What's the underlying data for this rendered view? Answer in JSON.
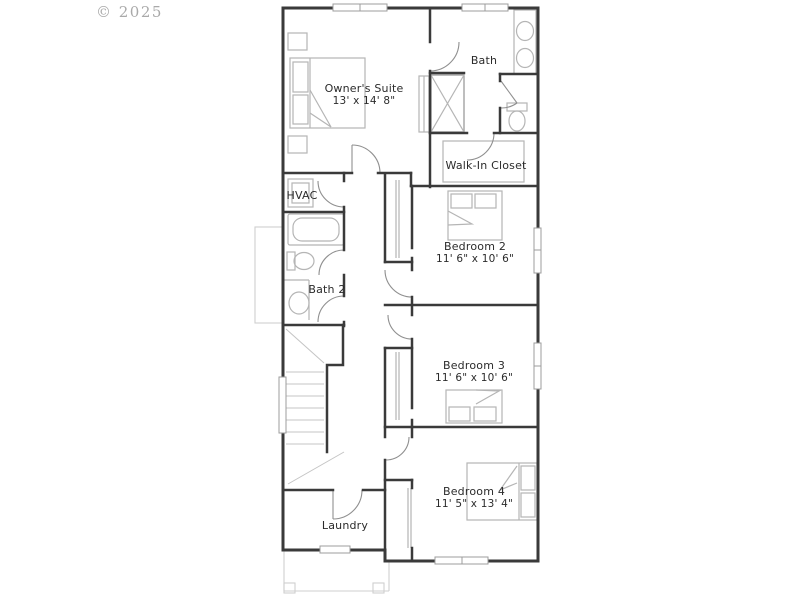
{
  "watermark": "© 2025",
  "rooms": {
    "owners_suite": {
      "name": "Owner's Suite",
      "dims": "13' x 14' 8\""
    },
    "bath": {
      "name": "Bath"
    },
    "walk_in_closet": {
      "name": "Walk-In Closet"
    },
    "hvac": {
      "name": "HVAC"
    },
    "bath_2": {
      "name": "Bath 2"
    },
    "bedroom_2": {
      "name": "Bedroom 2",
      "dims": "11' 6\" x 10' 6\""
    },
    "bedroom_3": {
      "name": "Bedroom 3",
      "dims": "11' 6\" x 10' 6\""
    },
    "bedroom_4": {
      "name": "Bedroom 4",
      "dims": "11' 5\" x 13' 4\""
    },
    "laundry": {
      "name": "Laundry"
    }
  },
  "colors": {
    "background": "#ffffff",
    "wall": "#3a3a3a",
    "fixture": "#b5b5b5",
    "window": "#9c9c9c",
    "porch": "#cfcfcf",
    "text": "#2b2b2b",
    "watermark": "#9b9b9b"
  }
}
